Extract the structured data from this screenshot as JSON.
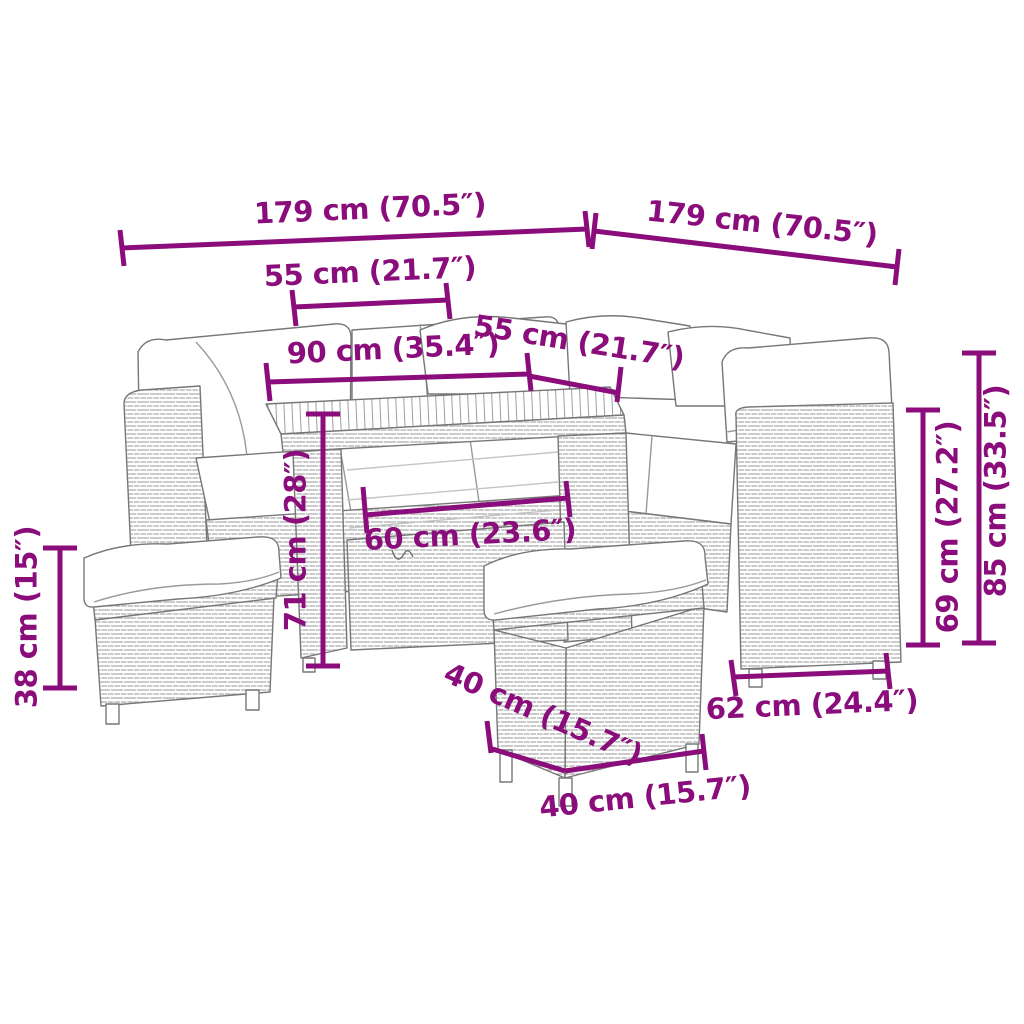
{
  "diagram": {
    "accent_color": "#8A0D7B",
    "art_color": "#7c7c7c",
    "dimensions": {
      "left_total": "179 cm (70.5″)",
      "right_total": "179 cm (70.5″)",
      "left_seat_width": "55 cm (21.7″)",
      "table_length": "90 cm (35.4″)",
      "right_seat_width": "55 cm (21.7″)",
      "table_height": "71 cm (28″)",
      "stool_height": "38 cm (15″)",
      "table_base_width": "60 cm (23.6″)",
      "stool_depth": "40 cm (15.7″)",
      "stool_width": "40 cm (15.7″)",
      "sofa_depth": "62 cm (24.4″)",
      "backrest_height": "69 cm (27.2″)",
      "total_height": "85 cm (33.5″)"
    }
  }
}
